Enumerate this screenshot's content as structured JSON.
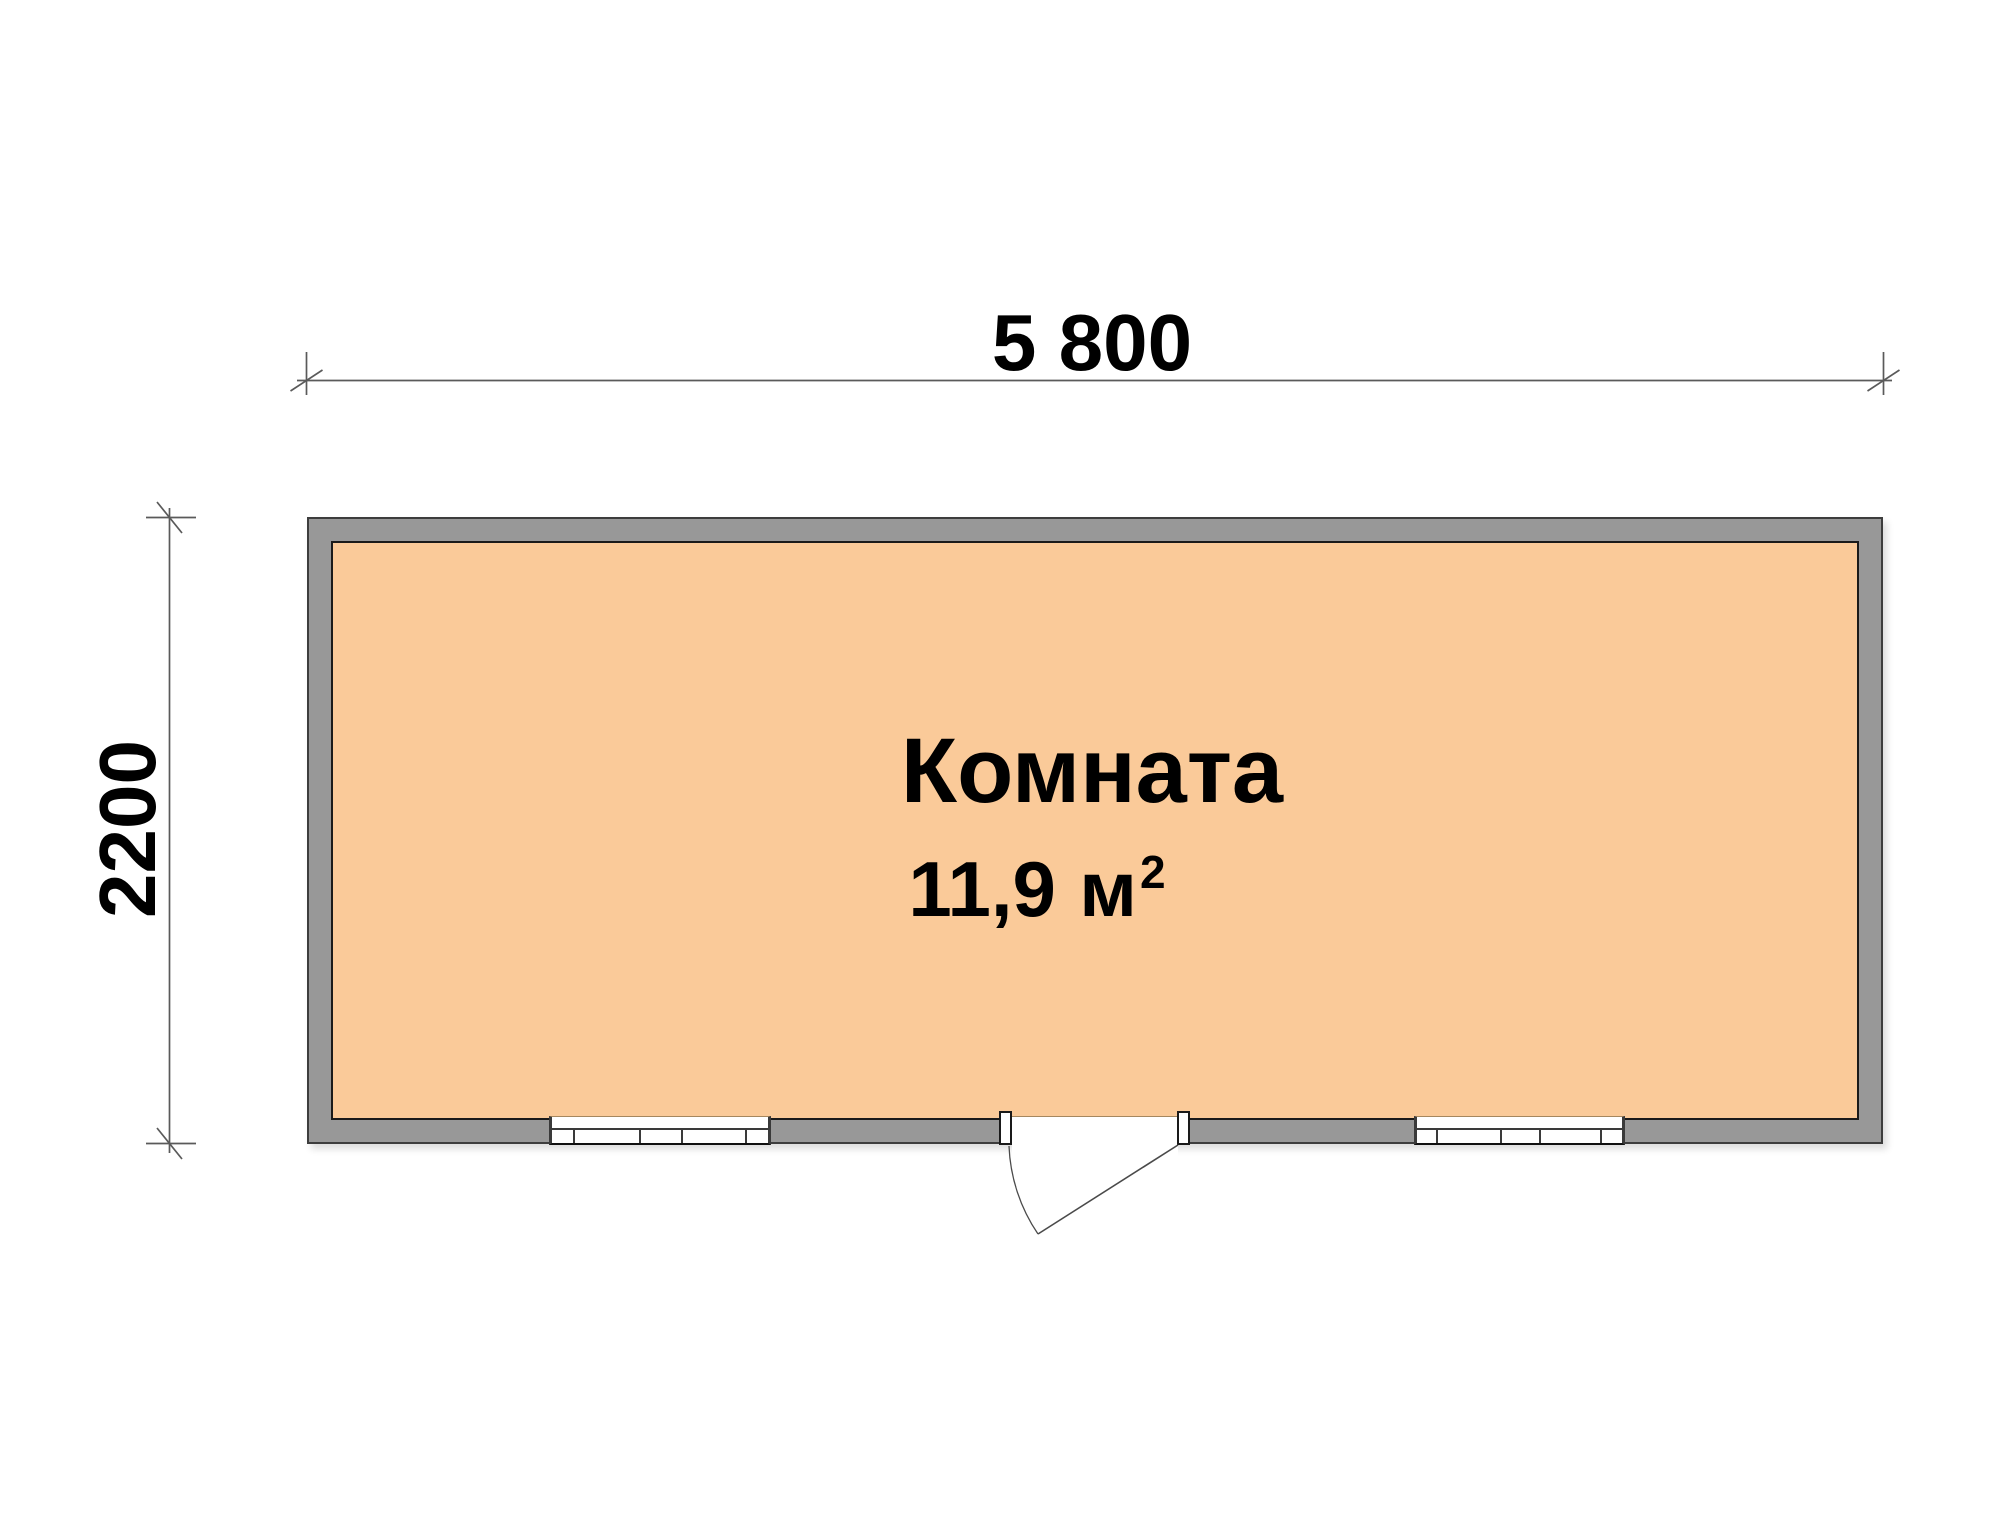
{
  "plan": {
    "room": {
      "name": "Комната",
      "area_value": "11,9",
      "area_unit": "м",
      "area_exponent": "2"
    },
    "dimensions": {
      "width_label": "5 800",
      "depth_label": "2200"
    },
    "symbols": {
      "windows": [
        "window-left",
        "window-right"
      ],
      "door": "single-swing-door"
    },
    "colors": {
      "background": "#FFFFFF",
      "wall_fill": "#989898",
      "wall_outline": "#3D3D3D",
      "room_fill": "#FACA99",
      "room_outline": "#1A1A1A",
      "window_line": "#3A3A3A",
      "window_sill": "#A5875F",
      "dimension_line": "#5A5A5A",
      "door_line": "#4A4A4A",
      "label_text": "#000000"
    }
  }
}
